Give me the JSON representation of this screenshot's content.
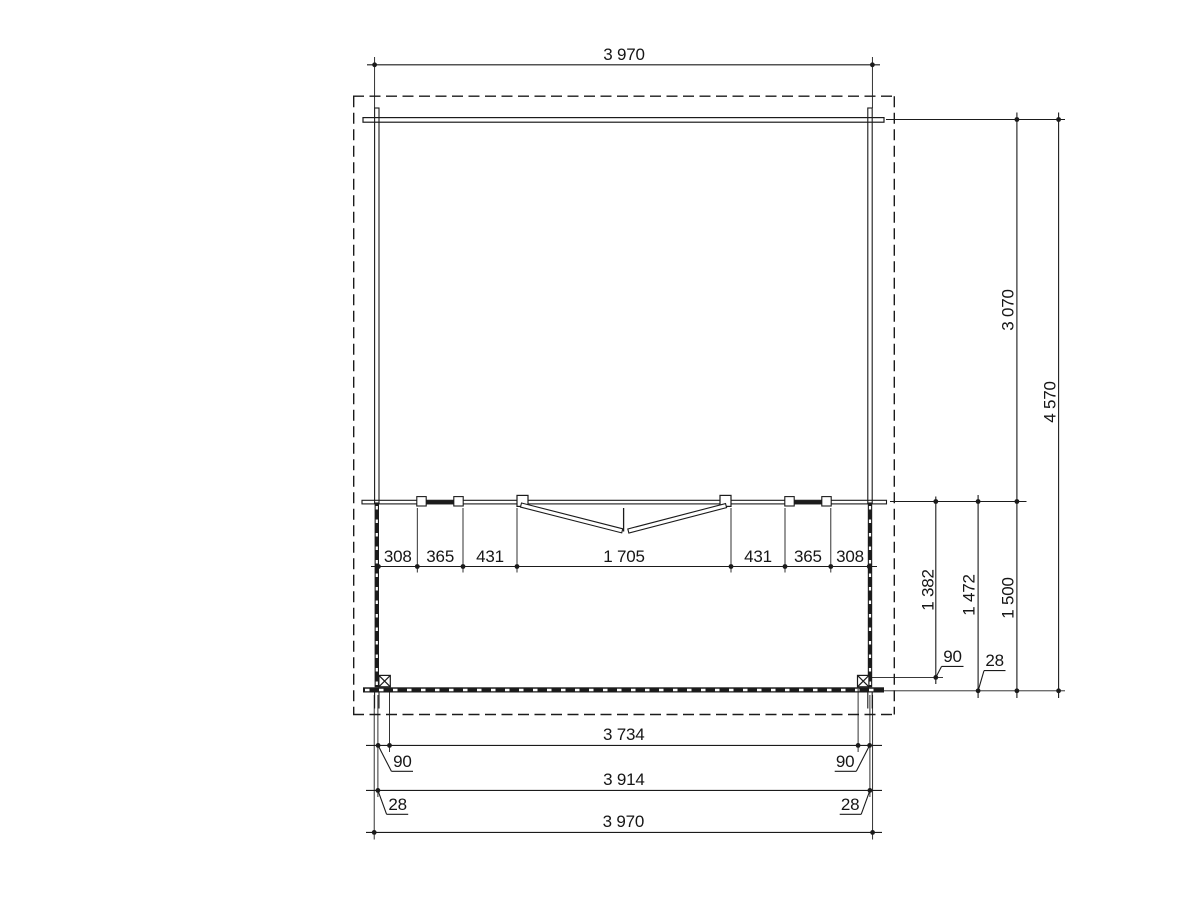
{
  "colors": {
    "ink": "#1b1b1b",
    "background": "#ffffff"
  },
  "dimensions": {
    "overall_width_top": "3 970",
    "front_wall_chain": [
      "308",
      "365",
      "431",
      "1 705",
      "431",
      "365",
      "308"
    ],
    "right_side": {
      "back_to_front_wall": "3 070",
      "overall_depth": "4 570",
      "front_wall_to_post": "1 382",
      "front_wall_to_beam_inner": "1 472",
      "terrace_depth": "1 500",
      "post_offset": "90",
      "beam_offset": "28"
    },
    "bottom": {
      "inner_width": "3 734",
      "wall_outer_width": "3 914",
      "overall_width": "3 970",
      "left_post_offset": "90",
      "right_post_offset": "90",
      "left_wall_offset": "28",
      "right_wall_offset": "28"
    }
  }
}
